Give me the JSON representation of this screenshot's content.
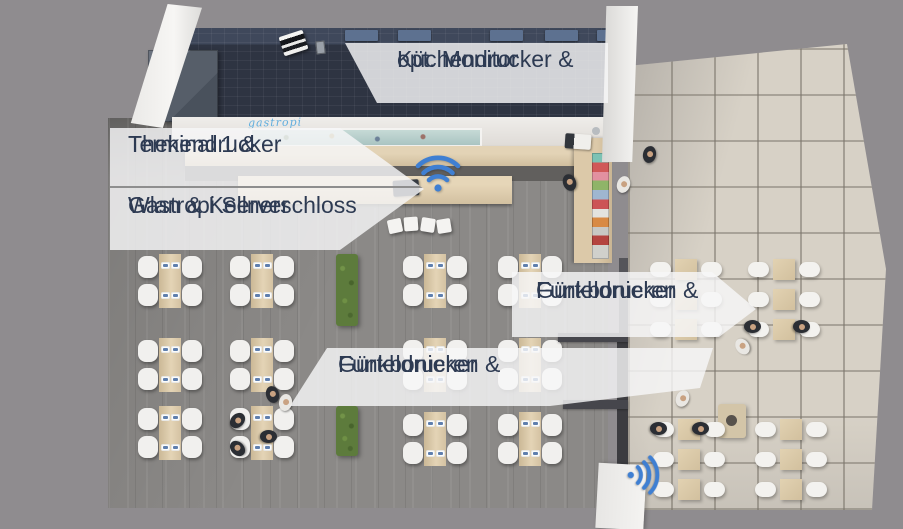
{
  "scene": {
    "description": "Top-down 3D rendering of a restaurant: kitchen, bar counter, indoor dining room and outdoor terrace with POS hardware callouts",
    "background_color": "#8f8c8f"
  },
  "callouts": {
    "kitchen_printer": {
      "line1": "Küchendrucker &",
      "line2": "opt. Monitor"
    },
    "terminal": {
      "line1": "Terminal 1 &",
      "line2": "Thekendrucker"
    },
    "server": {
      "line1": "Gastropi Server",
      "line2": "Wlan & Kellnerschloss"
    },
    "terrace_printer": {
      "line1": "Funkbonieren &",
      "line2": "Gürteldrucker"
    },
    "indoor_printer": {
      "line1": "Funkbonieren &",
      "line2": "Gürteldrucker"
    }
  },
  "branding": {
    "bar_front_logo": "gastropi"
  },
  "icons": [
    {
      "name": "wifi-icon-bar",
      "glyph": "wifi",
      "color": "#3f7fd2"
    },
    {
      "name": "wifi-icon-entrance",
      "glyph": "wifi",
      "color": "#3f7fd2"
    }
  ],
  "colors": {
    "label_background": "rgba(247,247,248,0.82)",
    "label_text": "#2d3a52",
    "wifi_blue": "#3f7fd2",
    "hedge_green": "#5d7b3c",
    "kitchen_floor": "#2e3442",
    "indoor_floor": "#8b8987",
    "terrace_tile": "#d7d1c6",
    "counter_wood": "#d3c09f"
  },
  "furniture": {
    "indoor_tables": 12,
    "terrace_tables": 12,
    "hedges": 2,
    "bar_stools": 4
  }
}
